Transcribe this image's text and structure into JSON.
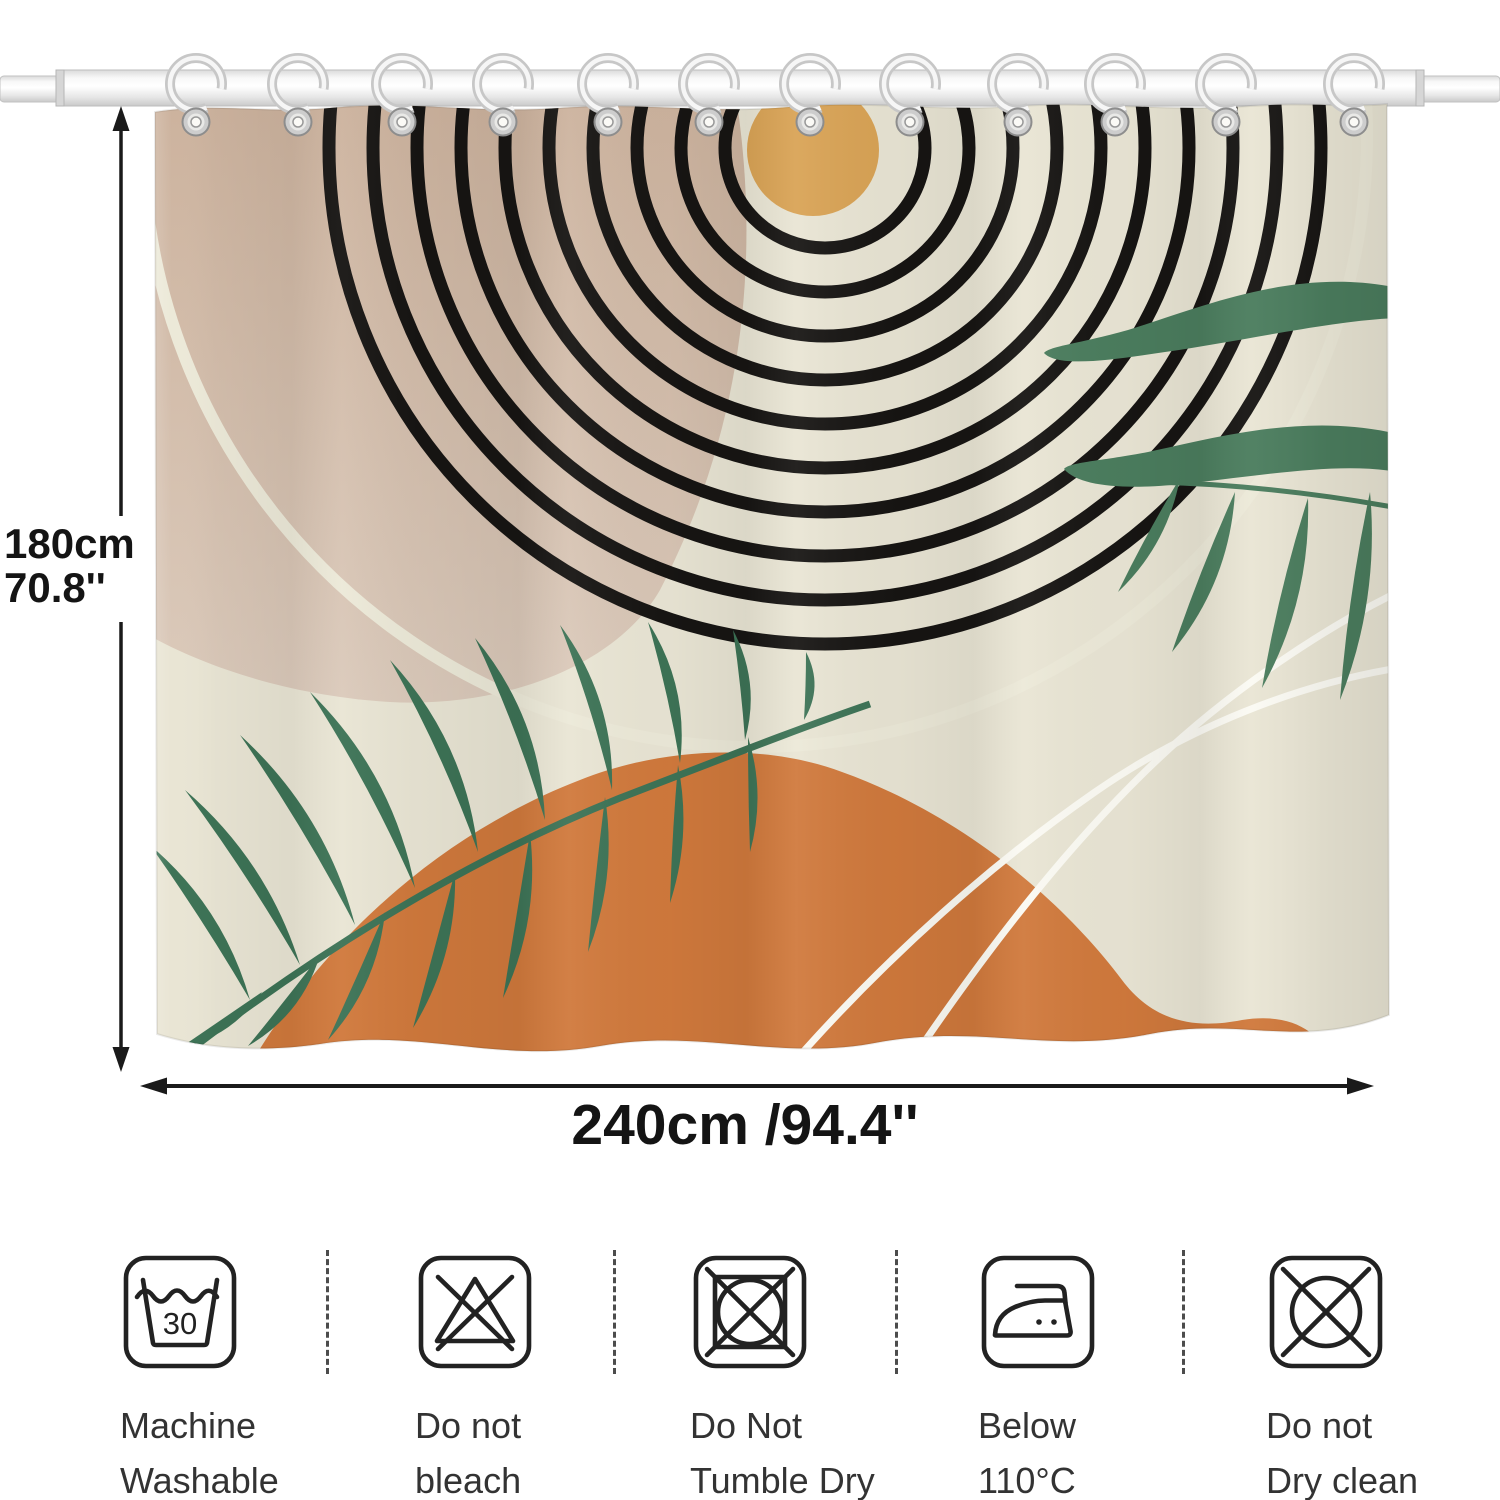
{
  "dimensions": {
    "height_cm": "180cm",
    "height_in": "70.8''",
    "width": "240cm /94.4''"
  },
  "care": {
    "items": [
      {
        "icon": "machine-wash-30-icon",
        "value": "30",
        "line1": "Machine",
        "line2": "Washable"
      },
      {
        "icon": "do-not-bleach-icon",
        "line1": "Do not",
        "line2": "bleach"
      },
      {
        "icon": "do-not-tumble-dry-icon",
        "line1": "Do Not",
        "line2": "Tumble Dry"
      },
      {
        "icon": "iron-below-110-icon",
        "line1": "Below",
        "line2": "110°C"
      },
      {
        "icon": "do-not-dry-clean-icon",
        "line1": "Do not",
        "line2": "Dry clean"
      }
    ]
  },
  "curtain": {
    "hook_count": 12,
    "colors": {
      "cream": "#e9e5d4",
      "tan": "#cfb7a3",
      "sun": "#d9a355",
      "rings": "#171513",
      "palm_green": "#3d7356",
      "olive_green": "#4b7d5e",
      "orange": "#d0793c",
      "vein_white": "#fbfaf3"
    }
  }
}
